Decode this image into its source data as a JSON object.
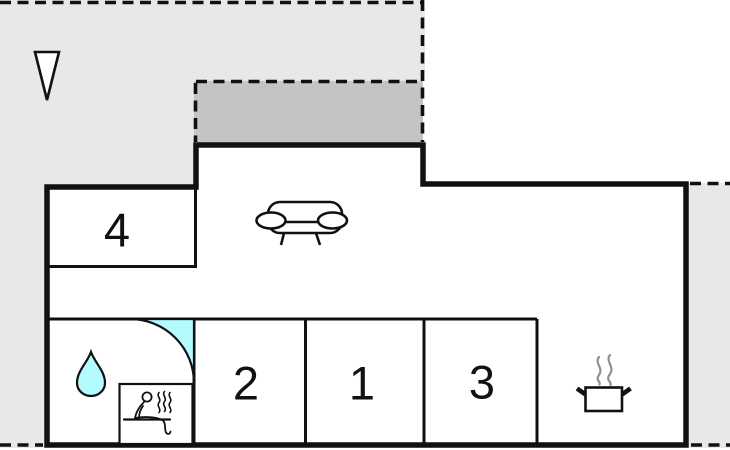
{
  "plan": {
    "title": "holiday-home-floor-plan",
    "rooms": [
      {
        "id": "bedroom-4",
        "label": "4"
      },
      {
        "id": "bedroom-2",
        "label": "2"
      },
      {
        "id": "bedroom-1",
        "label": "1"
      },
      {
        "id": "bedroom-3",
        "label": "3"
      },
      {
        "id": "living-room",
        "icon": "sofa-icon"
      },
      {
        "id": "bathroom",
        "icon": "water-drop-icon"
      },
      {
        "id": "sauna",
        "icon": "sauna-icon"
      },
      {
        "id": "kitchen",
        "icon": "cooking-pot-icon"
      },
      {
        "id": "terrace",
        "icon": "shaded-terrace-area"
      }
    ],
    "icons": [
      "north-arrow-icon",
      "sofa-icon",
      "water-drop-icon",
      "shower-quarter-circle",
      "sauna-icon",
      "cooking-pot-icon"
    ]
  },
  "colors": {
    "background": "#ffffff",
    "ground": "#e8e8e7",
    "terrace": "#c4c4c4",
    "water": "#b3fbfe",
    "wall": "#111111",
    "steam": "#909090"
  }
}
